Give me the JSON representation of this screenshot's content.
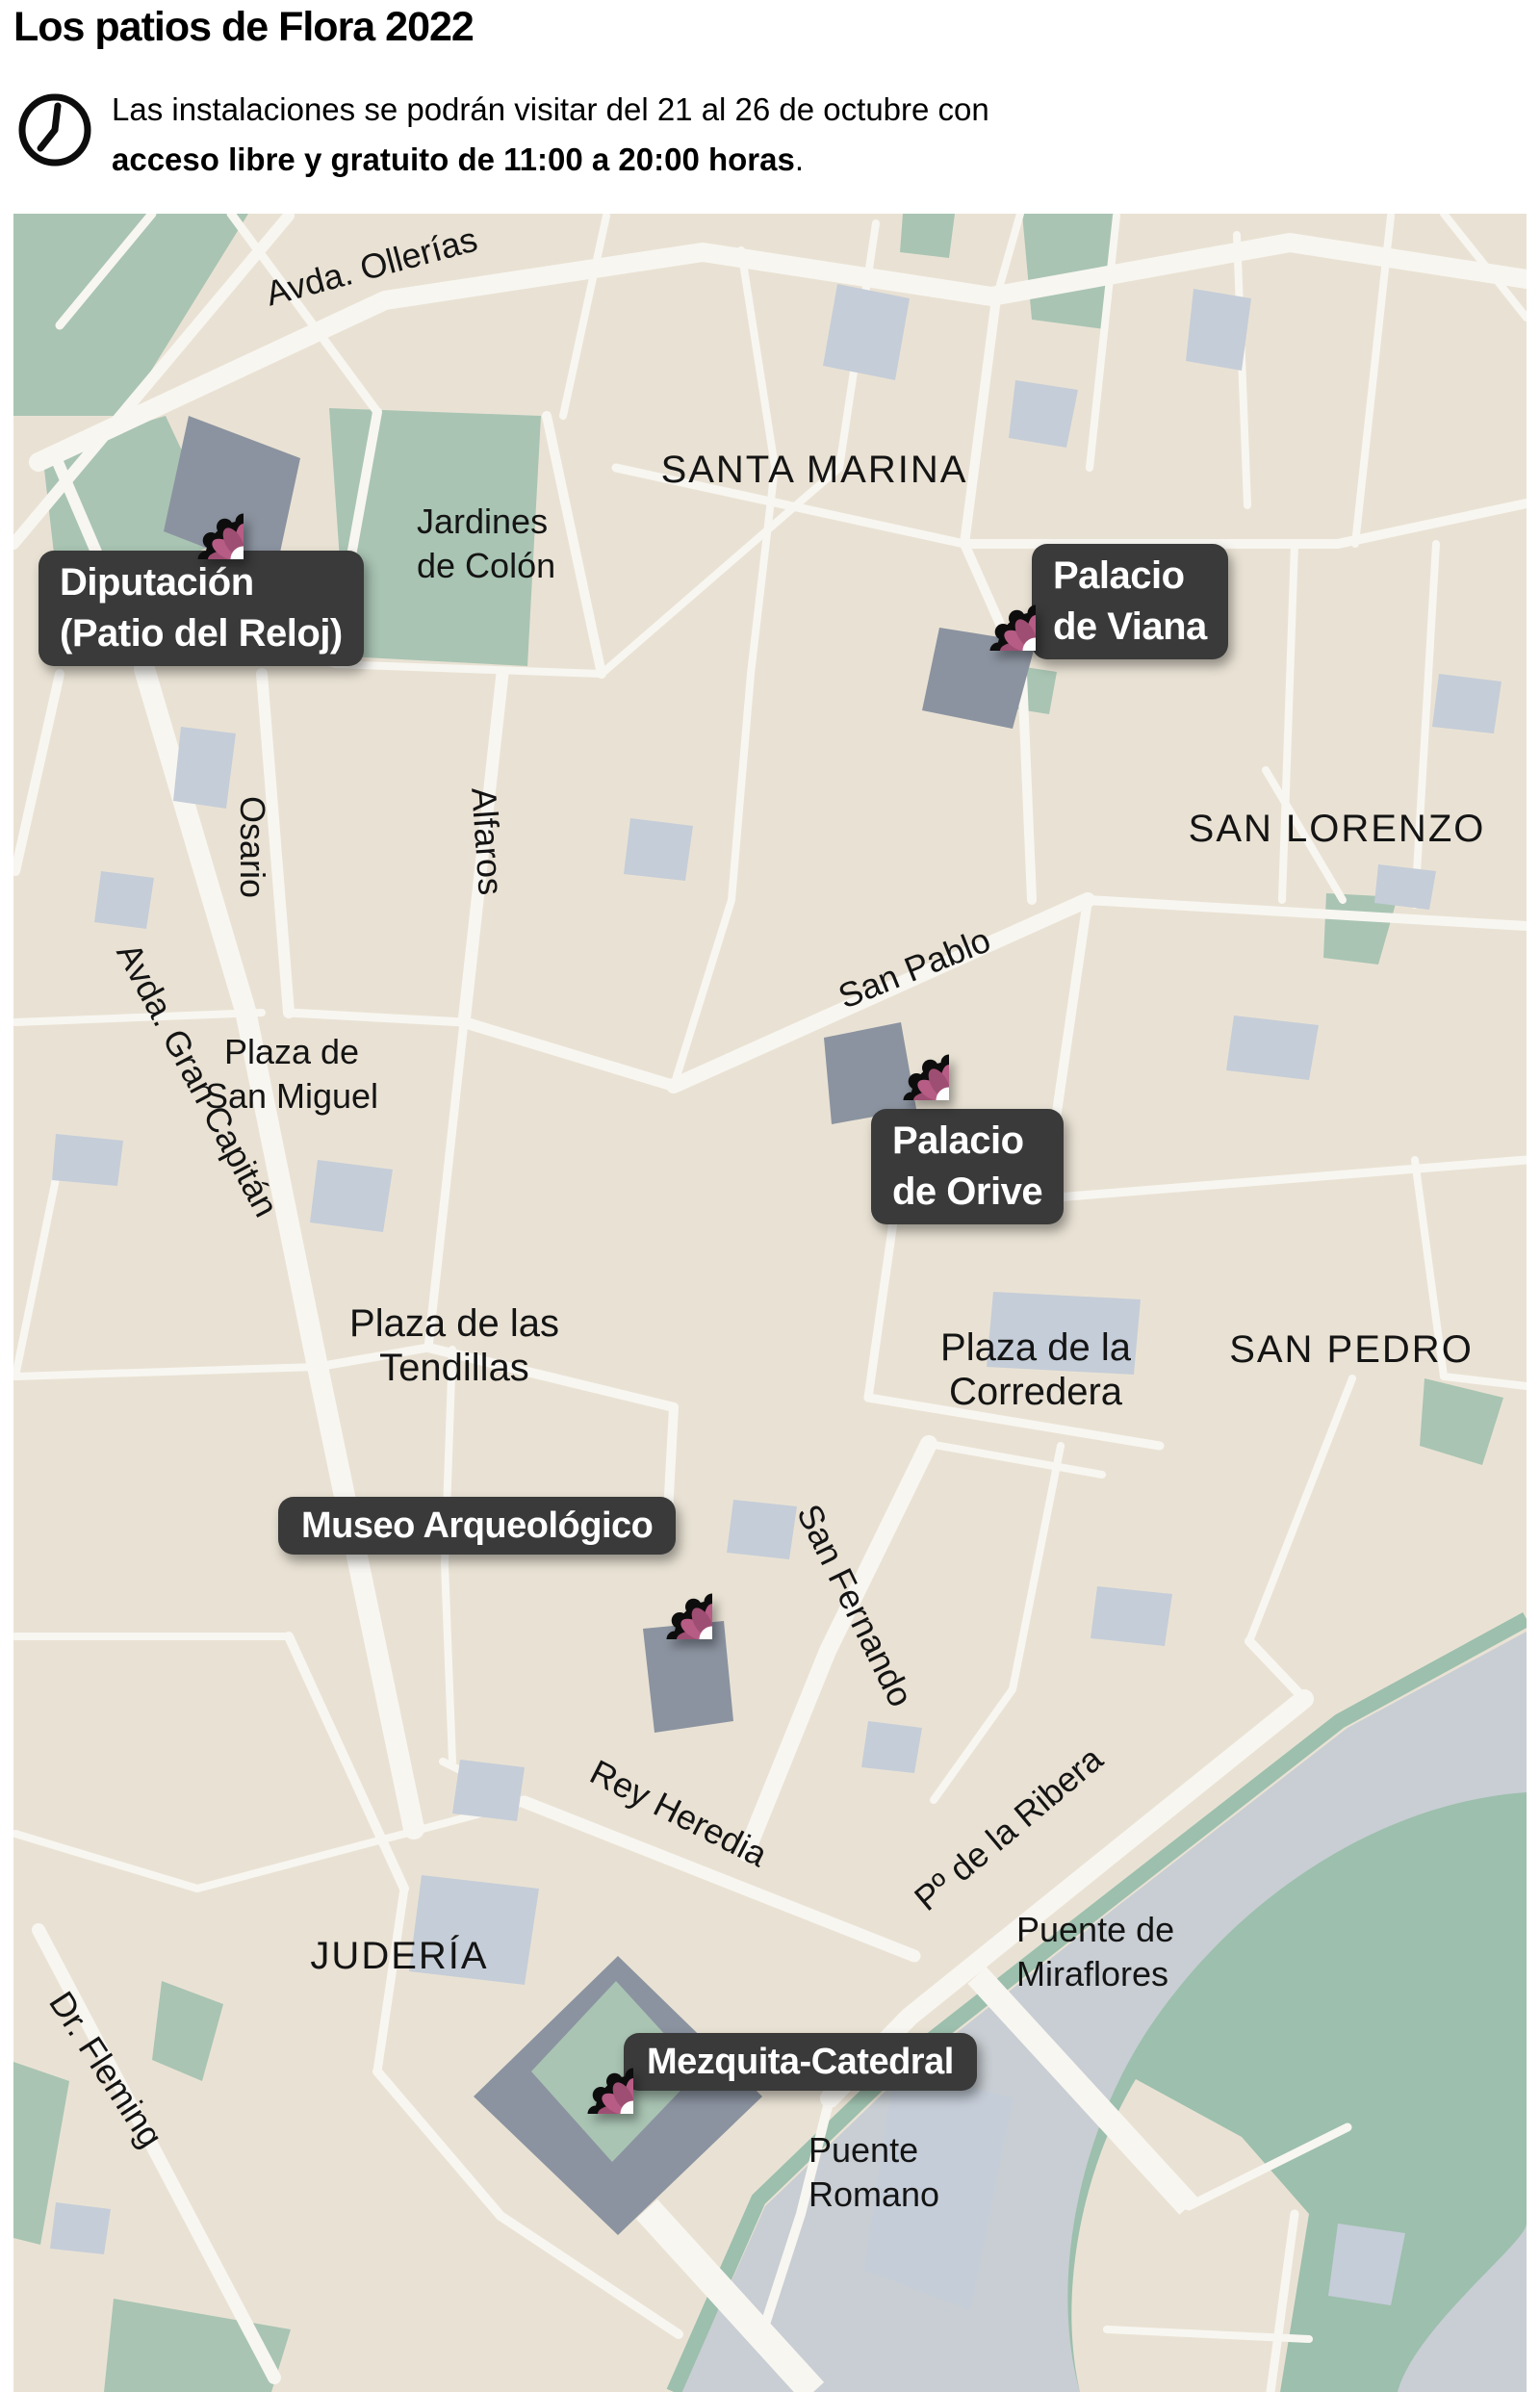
{
  "header": {
    "title": "Los patios de Flora 2022",
    "subtitle_line1": "Las instalaciones se podrán visitar del 21 al 26 de octubre con",
    "subtitle_bold": "acceso libre y gratuito de 11:00 a 20:00 horas",
    "subtitle_end": ".",
    "clock_icon": "clock-icon"
  },
  "map": {
    "districts": {
      "santa_marina": "SANTA MARINA",
      "san_lorenzo": "SAN LORENZO",
      "san_pedro": "SAN PEDRO",
      "juderia": "JUDERÍA"
    },
    "streets": {
      "ollerias": "Avda. Ollerías",
      "osario": "Osario",
      "alfaros": "Alfaros",
      "gran_capitan": "Avda. Gran Capitán",
      "san_pablo": "San Pablo",
      "san_fernando": "San Fernando",
      "rey_heredia": "Rey Heredia",
      "dr_fleming": "Dr. Fleming",
      "ribera": "Pº de la Ribera"
    },
    "places": {
      "jardines": [
        "Jardines",
        "de Colón"
      ],
      "san_miguel": [
        "Plaza de",
        "San Miguel"
      ],
      "tendillas": [
        "Plaza de las",
        "Tendillas"
      ],
      "corredera": [
        "Plaza de la",
        "Corredera"
      ],
      "miraflores": [
        "Puente de",
        "Miraflores"
      ],
      "romano": [
        "Puente",
        "Romano"
      ]
    },
    "venues": [
      {
        "id": "diputacion",
        "name_lines": [
          "Diputación",
          "(Patio del Reloj)"
        ]
      },
      {
        "id": "palacio-viana",
        "name_lines": [
          "Palacio",
          "de Viana"
        ]
      },
      {
        "id": "palacio-orive",
        "name_lines": [
          "Palacio",
          "de Orive"
        ]
      },
      {
        "id": "museo-arqueologico",
        "name_lines": [
          "Museo Arqueológico"
        ]
      },
      {
        "id": "mezquita-catedral",
        "name_lines": [
          "Mezquita-Catedral"
        ]
      }
    ],
    "marker_icon": "flower-icon"
  },
  "colors": {
    "land": "#e9e2d4",
    "street": "#f8f6f1",
    "park": "#a9c4b3",
    "water": "#c8ced3",
    "building": "#c5cdd8",
    "building_dark": "#8b93a0",
    "label_box": "#3a3a3a",
    "flower_petal_light": "#b65c85",
    "flower_petal_dark": "#9e4e72",
    "flower_center": "#fdfdfd"
  }
}
